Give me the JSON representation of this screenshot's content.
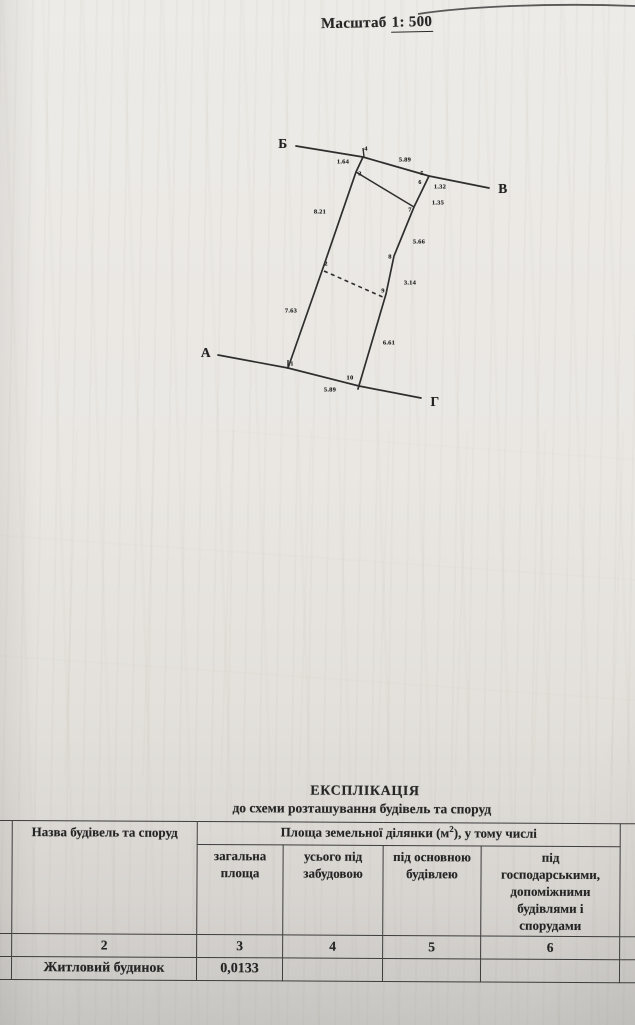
{
  "page": {
    "scale_label": "Масштаб",
    "scale_value": "1: 500"
  },
  "diagram": {
    "corner_labels": {
      "top": "Б",
      "right": "В",
      "left": "А",
      "bottom": "Г"
    },
    "point_labels": {
      "p1": "1",
      "p2": "2",
      "p3": "3",
      "p4": "4",
      "p5": "5",
      "p6": "6",
      "p7": "7",
      "p8": "8",
      "p9": "9",
      "p10": "10"
    },
    "measurements": {
      "m_3_4": "1.64",
      "m_4_5_top": "5.89",
      "m_5_6": "1.32",
      "m_6_7": "1.35",
      "m_3_2": "8.21",
      "m_7_8": "5.66",
      "m_8_9": "3.14",
      "m_2_1": "7.63",
      "m_9_10": "6.61",
      "m_1_10_bottom": "5.89"
    },
    "line_color": "#2e2e2e"
  },
  "explication": {
    "title": "ЕКСПЛІКАЦІЯ",
    "subtitle": "до схеми розташування будівель та споруд",
    "name_column_header": "Назва будівель та споруд",
    "area_header": {
      "pre": "Площа земельної ділянки (м",
      "sup": "2",
      "post": "), у тому числі"
    },
    "subheaders": [
      "загальна площа",
      "усього під забудовою",
      "під основною будівлею",
      "під господарськими, допоміжними будівлями і спорудами"
    ],
    "column_numbers": [
      "2",
      "3",
      "4",
      "5",
      "6"
    ],
    "rows": [
      {
        "name": "Житловий будинок",
        "total": "0,0133",
        "built": "",
        "main": "",
        "aux": ""
      }
    ]
  }
}
